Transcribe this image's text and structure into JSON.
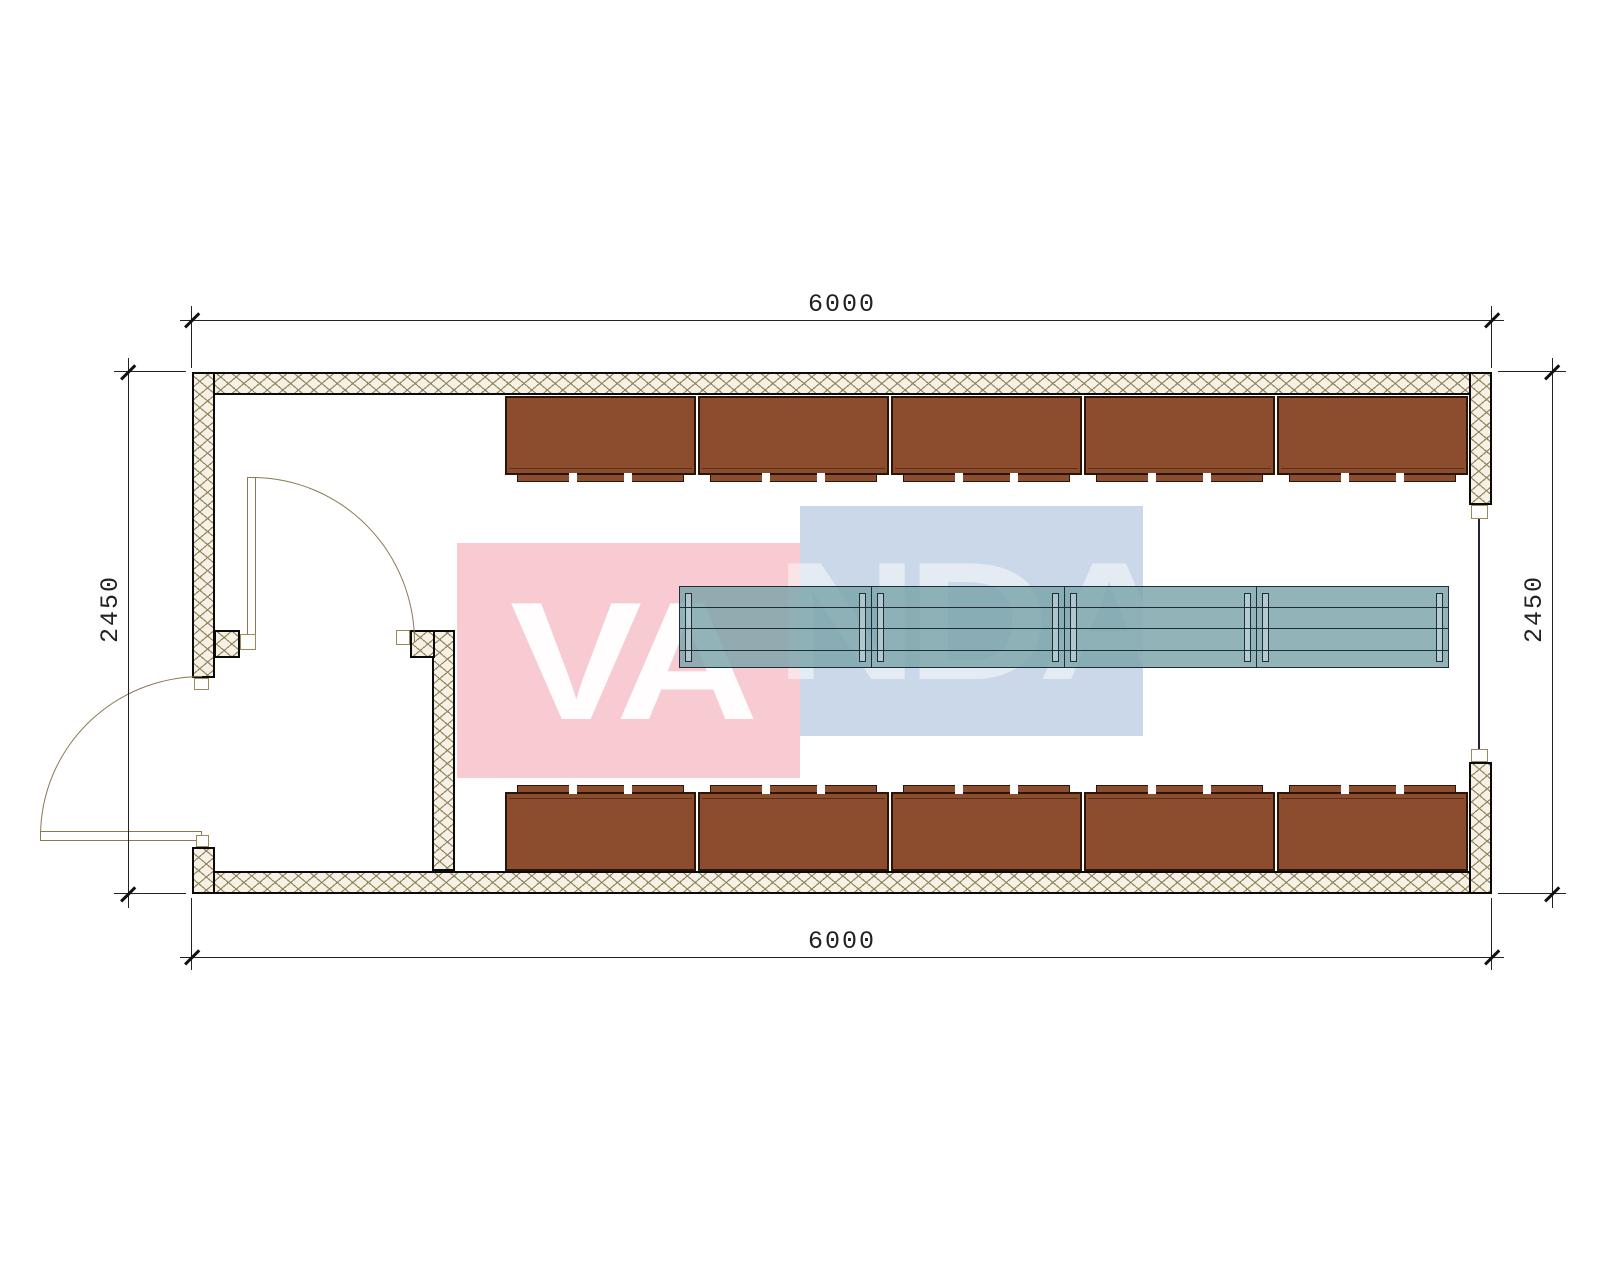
{
  "drawing": {
    "type": "floor-plan",
    "dim_top": "6000",
    "dim_bottom": "6000",
    "dim_left": "2450",
    "dim_right": "2450"
  },
  "watermark": {
    "brand": "VANDA",
    "pink_part": "VA",
    "blue_part": "NDA"
  },
  "furniture": {
    "top_cabinet_count": 5,
    "bottom_cabinet_count": 5,
    "table_segment_count": 4
  },
  "colors": {
    "pink": "#f8cbd2",
    "blue": "#cbd8e9",
    "wall_fill": "#f6f1e4",
    "wall_hatch_line": "#90865f",
    "cabinet_fill": "#8B4D2E",
    "cabinet_border": "#2b1409",
    "table_fill": "rgba(122,164,169,0.82)",
    "table_line": "#1d2d3a",
    "door_line": "#8a7a52",
    "dim_color": "#222222"
  }
}
